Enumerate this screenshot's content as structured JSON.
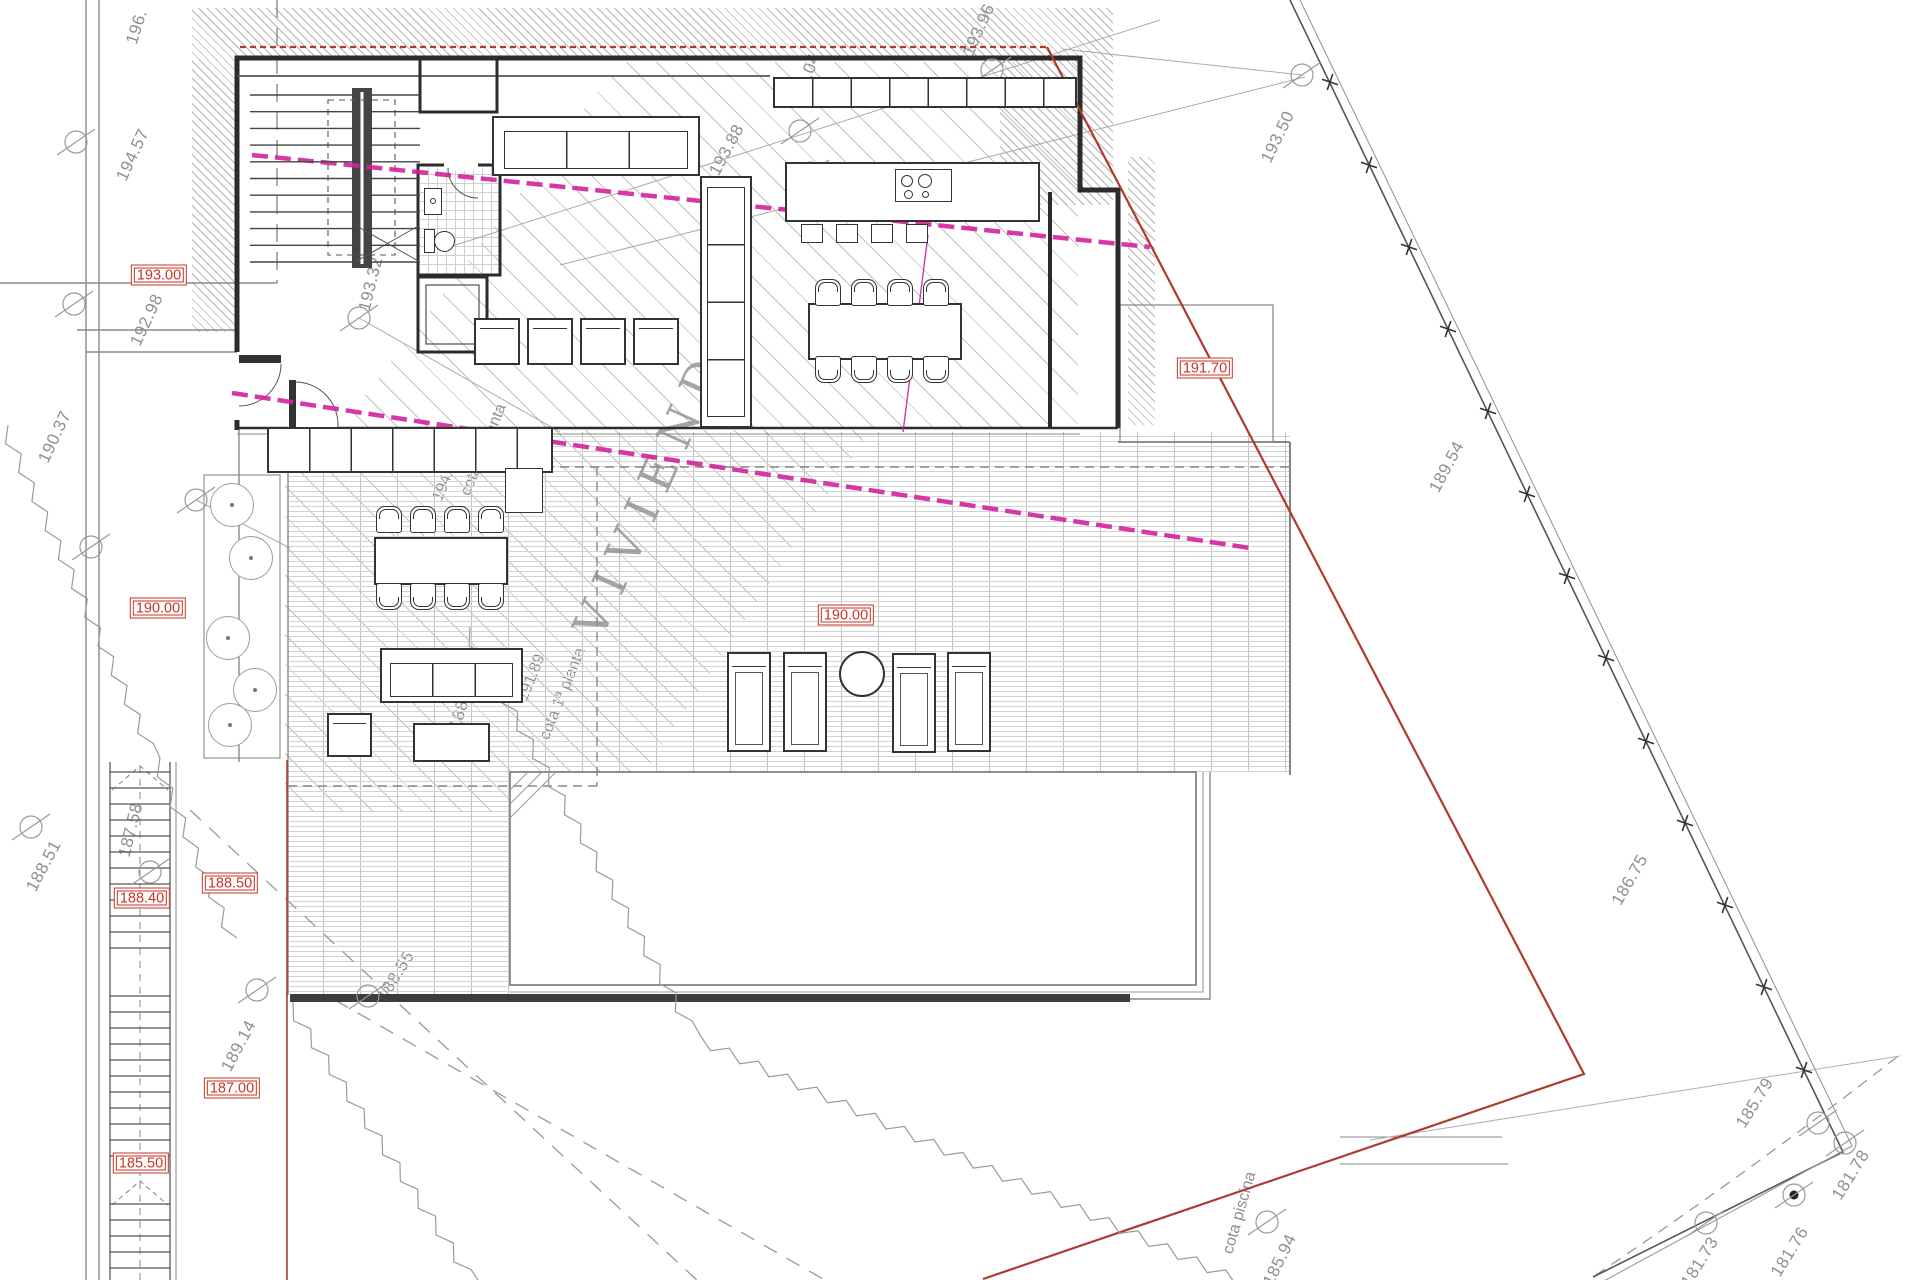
{
  "title": "VIVIENDA",
  "elevations": [
    {
      "label": "193.00"
    },
    {
      "label": "191.70"
    },
    {
      "label": "190.00"
    },
    {
      "label": "190.00"
    },
    {
      "label": "188.40"
    },
    {
      "label": "188.50"
    },
    {
      "label": "187.00"
    },
    {
      "label": "185.50"
    }
  ],
  "contours": [
    {
      "text": "196."
    },
    {
      "text": "194.57"
    },
    {
      "text": "192.98"
    },
    {
      "text": "190.37"
    },
    {
      "text": "188.51"
    },
    {
      "text": "187.58"
    },
    {
      "text": "189.14"
    },
    {
      "text": "188.55"
    },
    {
      "text": "188.90"
    },
    {
      "text": "193.32"
    },
    {
      "text": "193.88"
    },
    {
      "text": "194.04"
    },
    {
      "text": "193.96"
    },
    {
      "text": "193.50"
    },
    {
      "text": "189.54"
    },
    {
      "text": "186.75"
    },
    {
      "text": "185.79"
    },
    {
      "text": "181.78"
    },
    {
      "text": "181.76"
    },
    {
      "text": "181.73"
    },
    {
      "text": "185.94"
    }
  ],
  "annotations": {
    "cota_planta2_val": "194.60",
    "cota_planta2": "cota 2ª planta",
    "cota_planta1_val": "191.89",
    "cota_planta1": "cota 1ª planta",
    "cota_piscina": "cota piscina",
    "dim": "4.05"
  },
  "colors": {
    "elevation_box": "#c0392b",
    "boundary_red": "#b03a2e",
    "section_pink": "#d4219c",
    "contour_text": "#8f8f8f",
    "walls": "#2b2b2b"
  }
}
